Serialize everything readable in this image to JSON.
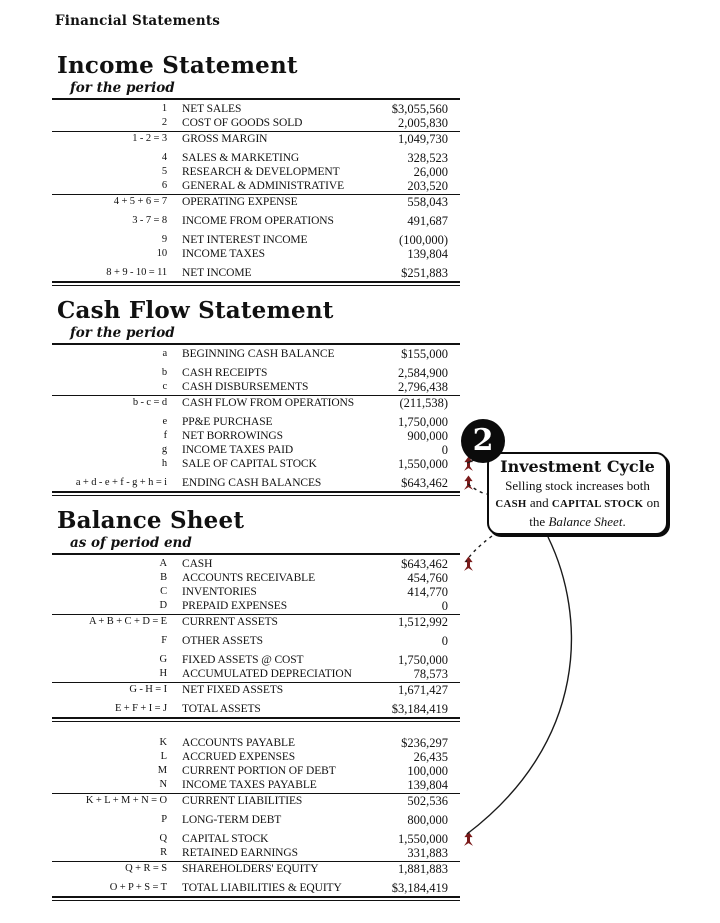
{
  "header": {
    "title": "Financial Statements"
  },
  "colors": {
    "ink": "#111111",
    "increase_arrow": "#7a1a1a",
    "connector": "#1a1a1a",
    "badge_bg": "#0b0b0b"
  },
  "icons": {
    "increase_arrow": "red-up-arrow"
  },
  "sections": [
    {
      "id": "income-statement",
      "title": "Income Statement",
      "subtitle": "for the period",
      "rows": [
        {
          "formula": "1",
          "label": "NET SALES",
          "value": "$3,055,560"
        },
        {
          "formula": "2",
          "label": "COST OF GOODS SOLD",
          "value": "2,005,830",
          "rule_below": true
        },
        {
          "formula": "1 - 2 = 3",
          "label": "GROSS MARGIN",
          "value": "1,049,730",
          "gap_below": true
        },
        {
          "formula": "4",
          "label": "SALES & MARKETING",
          "value": "328,523"
        },
        {
          "formula": "5",
          "label": "RESEARCH & DEVELOPMENT",
          "value": "26,000"
        },
        {
          "formula": "6",
          "label": "GENERAL & ADMINISTRATIVE",
          "value": "203,520",
          "rule_below": true
        },
        {
          "formula": "4 + 5 + 6 = 7",
          "label": "OPERATING EXPENSE",
          "value": "558,043",
          "gap_below": true
        },
        {
          "formula": "3 - 7 = 8",
          "label": "INCOME FROM OPERATIONS",
          "value": "491,687",
          "gap_below": true
        },
        {
          "formula": "9",
          "label": "NET INTEREST INCOME",
          "value": "(100,000)"
        },
        {
          "formula": "10",
          "label": "INCOME TAXES",
          "value": "139,804",
          "gap_below": true
        },
        {
          "formula": "8 + 9 - 10 = 11",
          "label": "NET INCOME",
          "value": "$251,883",
          "double_below": true
        }
      ]
    },
    {
      "id": "cash-flow-statement",
      "title": "Cash Flow Statement",
      "subtitle": "for the period",
      "rows": [
        {
          "formula": "a",
          "label": "BEGINNING CASH BALANCE",
          "value": "$155,000",
          "gap_below": true
        },
        {
          "formula": "b",
          "label": "CASH RECEIPTS",
          "value": "2,584,900"
        },
        {
          "formula": "c",
          "label": "CASH DISBURSEMENTS",
          "value": "2,796,438",
          "rule_below": true
        },
        {
          "formula": "b - c = d",
          "label": "CASH FLOW FROM OPERATIONS",
          "value": "(211,538)",
          "gap_below": true
        },
        {
          "formula": "e",
          "label": "PP&E PURCHASE",
          "value": "1,750,000"
        },
        {
          "formula": "f",
          "label": "NET BORROWINGS",
          "value": "900,000"
        },
        {
          "formula": "g",
          "label": "INCOME TAXES PAID",
          "value": "0"
        },
        {
          "formula": "h",
          "label": "SALE OF CAPITAL STOCK",
          "value": "1,550,000",
          "arrow": true,
          "gap_below": true
        },
        {
          "formula": "a + d - e + f - g + h = i",
          "label": "ENDING CASH BALANCES",
          "value": "$643,462",
          "arrow": true,
          "double_below": true
        }
      ]
    },
    {
      "id": "balance-sheet",
      "title": "Balance Sheet",
      "subtitle": "as of period end",
      "rows": [
        {
          "formula": "A",
          "label": "CASH",
          "value": "$643,462",
          "arrow": true
        },
        {
          "formula": "B",
          "label": "ACCOUNTS RECEIVABLE",
          "value": "454,760"
        },
        {
          "formula": "C",
          "label": "INVENTORIES",
          "value": "414,770"
        },
        {
          "formula": "D",
          "label": "PREPAID EXPENSES",
          "value": "0",
          "rule_below": true
        },
        {
          "formula": "A + B + C + D = E",
          "label": "CURRENT ASSETS",
          "value": "1,512,992",
          "gap_below": true
        },
        {
          "formula": "F",
          "label": "OTHER ASSETS",
          "value": "0",
          "gap_below": true
        },
        {
          "formula": "G",
          "label": "FIXED ASSETS @ COST",
          "value": "1,750,000"
        },
        {
          "formula": "H",
          "label": "ACCUMULATED DEPRECIATION",
          "value": "78,573",
          "rule_below": true
        },
        {
          "formula": "G - H = I",
          "label": "NET FIXED ASSETS",
          "value": "1,671,427",
          "gap_below": true
        },
        {
          "formula": "E + F + I = J",
          "label": "TOTAL ASSETS",
          "value": "$3,184,419",
          "double_below": true,
          "section_gap_below": true
        },
        {
          "formula": "K",
          "label": "ACCOUNTS PAYABLE",
          "value": "$236,297"
        },
        {
          "formula": "L",
          "label": "ACCRUED EXPENSES",
          "value": "26,435"
        },
        {
          "formula": "M",
          "label": "CURRENT PORTION OF DEBT",
          "value": "100,000"
        },
        {
          "formula": "N",
          "label": "INCOME TAXES PAYABLE",
          "value": "139,804",
          "rule_below": true
        },
        {
          "formula": "K + L + M + N = O",
          "label": "CURRENT LIABILITIES",
          "value": "502,536",
          "gap_below": true
        },
        {
          "formula": "P",
          "label": "LONG-TERM DEBT",
          "value": "800,000",
          "gap_below": true
        },
        {
          "formula": "Q",
          "label": "CAPITAL STOCK",
          "value": "1,550,000",
          "arrow": true
        },
        {
          "formula": "R",
          "label": "RETAINED EARNINGS",
          "value": "331,883",
          "rule_below": true
        },
        {
          "formula": "Q + R = S",
          "label": "SHAREHOLDERS' EQUITY",
          "value": "1,881,883",
          "gap_below": true
        },
        {
          "formula": "O + P + S = T",
          "label": "TOTAL LIABILITIES & EQUITY",
          "value": "$3,184,419",
          "double_below": true
        }
      ]
    }
  ],
  "callout": {
    "number": "2",
    "title": "Investment Cycle",
    "body_segments": [
      {
        "text": "Selling stock increases both ",
        "style": "normal"
      },
      {
        "text": "CASH",
        "style": "caps"
      },
      {
        "text": " and ",
        "style": "normal"
      },
      {
        "text": "CAPITAL STOCK",
        "style": "caps"
      },
      {
        "text": " on the ",
        "style": "normal"
      },
      {
        "text": "Balance Sheet",
        "style": "italic"
      },
      {
        "text": ".",
        "style": "normal"
      }
    ]
  }
}
